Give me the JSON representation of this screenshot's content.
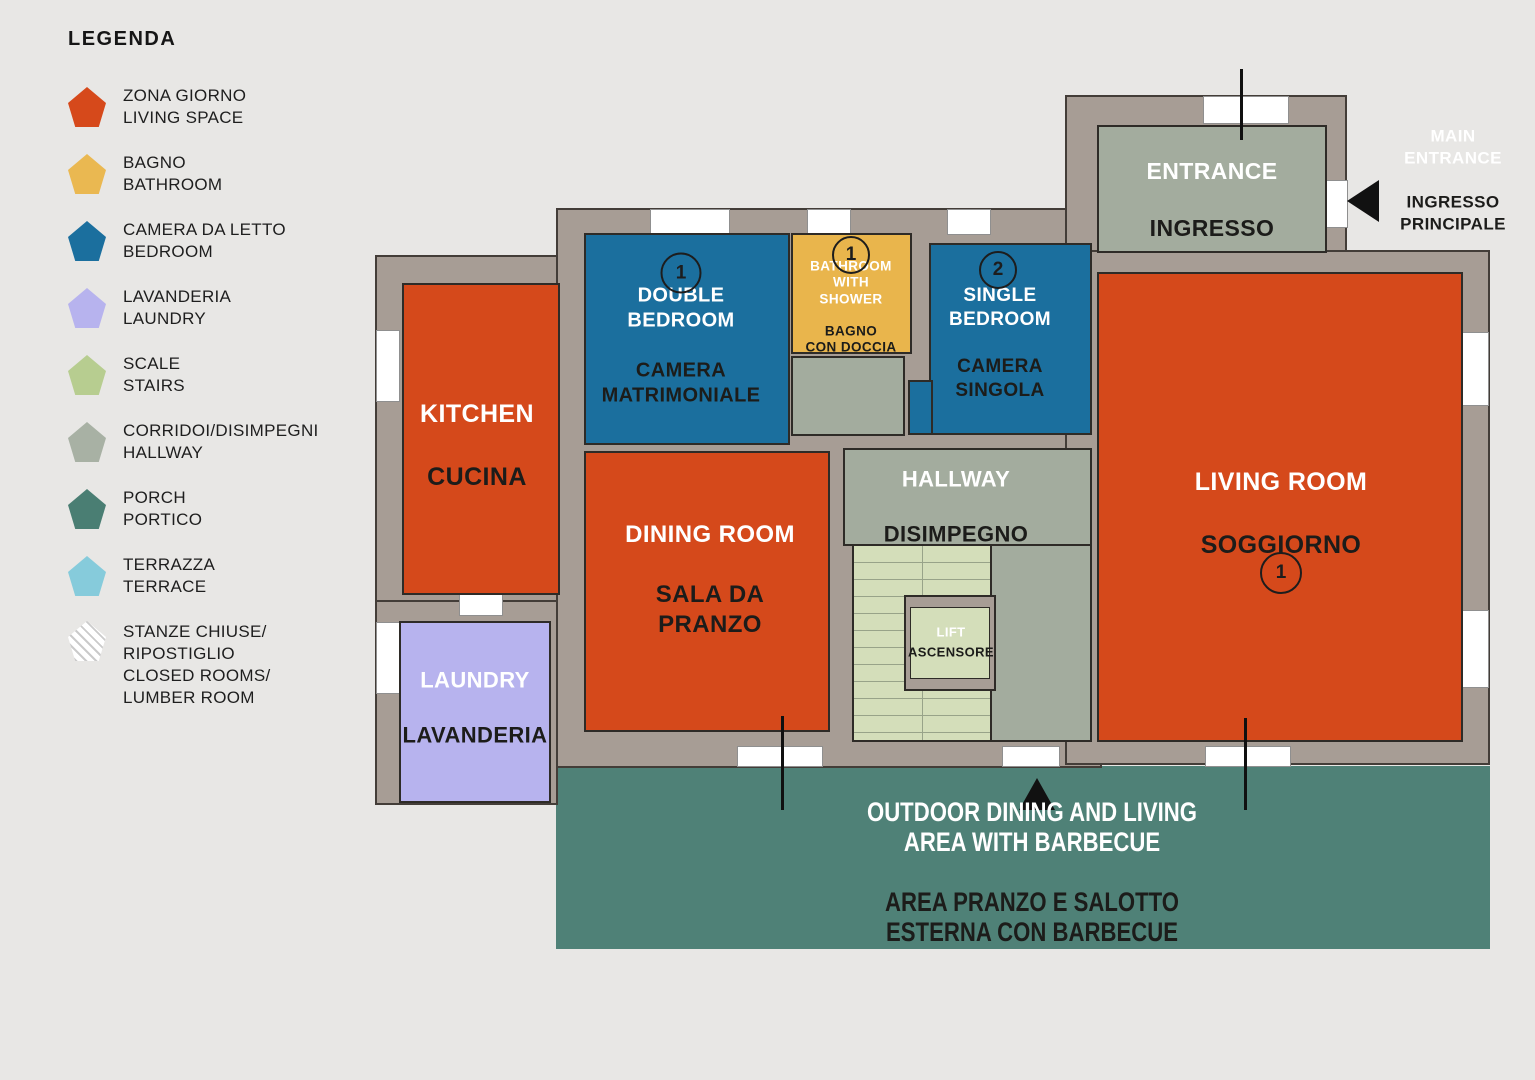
{
  "colors": {
    "background": "#E8E7E5",
    "walls": "#A79D95",
    "living_space": "#D5491B",
    "bathroom": "#E9B54C",
    "bedroom": "#1B6F9E",
    "laundry_room": "#B7B3EE",
    "stairs_floor": "#D4DEBA",
    "hallway_floor": "#A3AC9E",
    "porch": "#4F8177"
  },
  "legend": {
    "title": "LEGENDA",
    "items": [
      {
        "swatch": "#D6491B",
        "text": "ZONA GIORNO\nLIVING SPACE"
      },
      {
        "swatch": "#EAB851",
        "text": "BAGNO\nBATHROOM"
      },
      {
        "swatch": "#1B6F9E",
        "text": "CAMERA DA LETTO\nBEDROOM"
      },
      {
        "swatch": "#B7B3EE",
        "text": "LAVANDERIA\nLAUNDRY"
      },
      {
        "swatch": "#B7CD90",
        "text": "SCALE\nSTAIRS"
      },
      {
        "swatch": "#A8B1A4",
        "text": "CORRIDOI/DISIMPEGNI\nHALLWAY"
      },
      {
        "swatch": "#4A7E73",
        "text": "PORCH\nPORTICO"
      },
      {
        "swatch": "#86CBDB",
        "text": "TERRAZZA\nTERRACE"
      },
      {
        "swatch": "hatch",
        "text": "STANZE CHIUSE/\nRIPOSTIGLIO\nCLOSED ROOMS/\nLUMBER ROOM"
      }
    ]
  },
  "rooms": {
    "kitchen": {
      "en": "KITCHEN",
      "it": "CUCINA"
    },
    "dining": {
      "en": "DINING ROOM",
      "it": "SALA DA\nPRANZO"
    },
    "laundry": {
      "en": "LAUNDRY",
      "it": "LAVANDERIA"
    },
    "double_bedroom": {
      "badge": "1",
      "en": "DOUBLE\nBEDROOM",
      "it": "CAMERA\nMATRIMONIALE"
    },
    "bathroom": {
      "badge": "1",
      "en": "BATHROOM\nWITH\nSHOWER",
      "it": "BAGNO\nCON DOCCIA"
    },
    "single_bedroom": {
      "badge": "2",
      "en": "SINGLE\nBEDROOM",
      "it": "CAMERA\nSINGOLA"
    },
    "entrance": {
      "en": "ENTRANCE",
      "it": "INGRESSO"
    },
    "hallway": {
      "en": "HALLWAY",
      "it": "DISIMPEGNO"
    },
    "living": {
      "badge": "1",
      "en": "LIVING ROOM",
      "it": "SOGGIORNO"
    },
    "lift": {
      "en": "LIFT",
      "it": "ASCENSORE"
    },
    "outdoor": {
      "en": "OUTDOOR DINING AND LIVING\nAREA WITH BARBECUE",
      "it": "AREA PRANZO E SALOTTO\nESTERNA CON BARBECUE"
    },
    "main_entrance": {
      "en": "MAIN\nENTRANCE",
      "it": "INGRESSO\nPRINCIPALE"
    }
  }
}
